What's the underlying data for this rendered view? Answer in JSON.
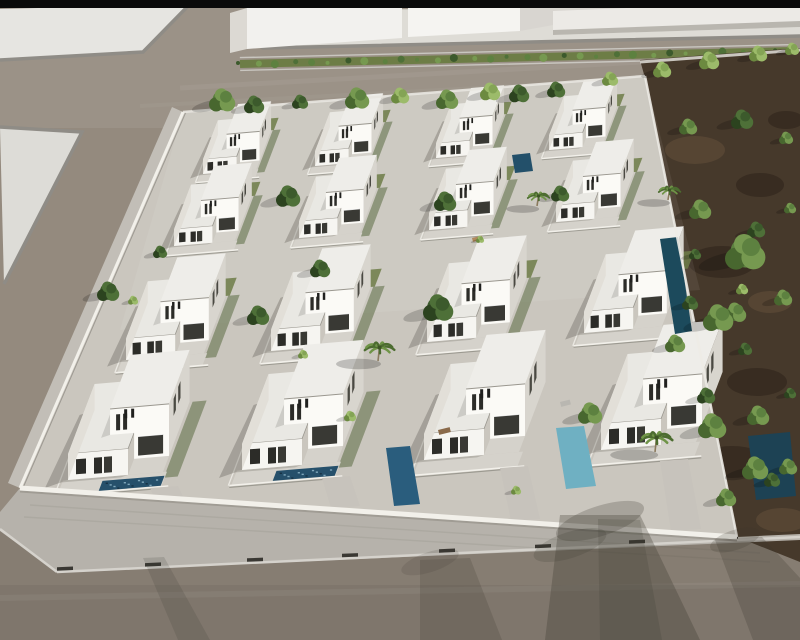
{
  "canvas": {
    "w": 800,
    "h": 640
  },
  "palette": {
    "black": "#0a0a0a",
    "road": "#948a7e",
    "plaza1": "#e6e5e1",
    "plaza2": "#dddcd7",
    "plaza3": "#dedcd6",
    "curb": "#8f8c86",
    "curb_light": "#d5d2cc",
    "building_face": "#f2f1ee",
    "building_side": "#dcd9d3",
    "building_roof": "#d8d5d0",
    "wall_band": "#eceae6",
    "wall_band_shade": "#b9b6af",
    "hedge_fill": "#6d7d46",
    "hedge_curb": "#c9c6c0",
    "dirt": "#46392b",
    "dirt_edge": "#cac6bf",
    "plot_ground": "#cac6be",
    "plot_left_band": "#c2beb7",
    "sidewalk_tile": "#b6b2ab",
    "wall_cap": "#f2f0ea",
    "wall_under": "#8a867e",
    "gate": "#3a3833",
    "roof_low": "#e9e8e3",
    "roof_high": "#eeede9",
    "roof_edge": "#9a978f",
    "wall_bright": "#f6f5f1",
    "wall_front": "#fbfaf6",
    "wall_mid": "#f1efe9",
    "wall_shade": "#e2dfd8",
    "wall_shade2": "#d8d5ce",
    "window": "#2c2c28",
    "window2": "#393934",
    "window_side": "#4a4942",
    "terrace": "#d5d2cb",
    "driveway": "#c7c3bc",
    "lawn": "#6d7c48",
    "lawn_dark": "#4f6136",
    "shadow": "#3a382f",
    "pool_mosaic": "#26506b",
    "pool_sp_l": "#8fb6c9",
    "pool_sp_d": "#142c3d",
    "palm_frond": "#6f9447",
    "palm_frond2": "#4c6c30",
    "palm_trunk": "#8a7a5e",
    "vent": "#20201e",
    "tree": {
      "d": [
        "#2c431f",
        "#3c5a2c",
        "#4e7038"
      ],
      "m": [
        "#48672f",
        "#5d8140",
        "#769950"
      ],
      "l": [
        "#6c8a40",
        "#84a455",
        "#9cbb6a"
      ]
    }
  },
  "black_strip": {
    "h": 8
  },
  "road_tints": [
    {
      "x": 0,
      "y": 8,
      "w": 800,
      "h": 120,
      "fill": "#ffffff",
      "op": 0.07
    },
    {
      "x": 0,
      "y": 520,
      "w": 800,
      "h": 120,
      "fill": "#000000",
      "op": 0.09
    },
    {
      "x": 0,
      "y": 585,
      "w": 800,
      "h": 55,
      "fill": "#000000",
      "op": 0.05
    }
  ],
  "road_lines": [
    [
      180,
      88,
      800,
      53,
      5,
      0.05,
      "#ffffff"
    ],
    [
      140,
      106,
      760,
      73,
      4,
      0.04,
      "#ffffff"
    ],
    [
      0,
      598,
      800,
      584,
      6,
      0.05,
      "#ffffff"
    ]
  ],
  "plazas": [
    {
      "name": "plaza-top-left",
      "pts": [
        [
          0,
          9
        ],
        [
          190,
          4
        ],
        [
          143,
          52
        ],
        [
          0,
          60
        ]
      ],
      "fill": "#e6e5e1",
      "curb_path": [
        [
          190,
          4
        ],
        [
          143,
          52
        ],
        [
          0,
          60
        ]
      ]
    },
    {
      "name": "plaza-left",
      "pts": [
        [
          0,
          127
        ],
        [
          82,
          132
        ],
        [
          4,
          284
        ]
      ],
      "fill": "#dddcd7",
      "curb_path": [
        [
          0,
          127
        ],
        [
          82,
          132
        ],
        [
          4,
          284
        ]
      ]
    },
    {
      "name": "plaza-top-forecourt",
      "pts": [
        [
          263,
          48
        ],
        [
          237,
          33
        ],
        [
          243,
          11
        ],
        [
          800,
          5
        ],
        [
          800,
          36
        ]
      ],
      "fill": "#dedcd6",
      "curb_path": [
        [
          237,
          33
        ],
        [
          263,
          48
        ],
        [
          800,
          36
        ]
      ]
    }
  ],
  "buildings": [
    {
      "name": "building-a-side",
      "pts": [
        [
          230,
          13
        ],
        [
          247,
          8
        ],
        [
          247,
          49
        ],
        [
          230,
          53
        ]
      ],
      "fill": "#dcd9d3"
    },
    {
      "name": "building-a-front",
      "pts": [
        [
          247,
          8
        ],
        [
          402,
          3
        ],
        [
          402,
          38
        ],
        [
          247,
          49
        ]
      ],
      "fill": "#f2f1ee"
    },
    {
      "name": "building-b-front",
      "pts": [
        [
          408,
          6
        ],
        [
          520,
          2
        ],
        [
          520,
          31
        ],
        [
          408,
          37
        ]
      ],
      "fill": "#f5f4f1"
    },
    {
      "name": "building-b-roof",
      "pts": [
        [
          520,
          2
        ],
        [
          622,
          0
        ],
        [
          637,
          10
        ],
        [
          520,
          31
        ]
      ],
      "fill": "#d8d5d0"
    },
    {
      "name": "building-c-wall",
      "pts": [
        [
          553,
          11
        ],
        [
          800,
          1
        ],
        [
          800,
          27
        ],
        [
          553,
          35
        ]
      ],
      "fill": "#eceae6"
    },
    {
      "name": "building-c-wall-shade",
      "pts": [
        [
          553,
          30
        ],
        [
          800,
          21
        ],
        [
          800,
          27
        ],
        [
          553,
          35
        ]
      ],
      "fill": "#b9b6af"
    }
  ],
  "hedge": {
    "x1": 240,
    "y1": 64,
    "x2": 795,
    "y2": 51,
    "half_w": 4,
    "bushes": 32
  },
  "dirt": {
    "pts": [
      [
        640,
        60
      ],
      [
        800,
        48
      ],
      [
        800,
        562
      ],
      [
        737,
        537
      ],
      [
        645,
        78
      ]
    ],
    "patches": [
      [
        695,
        150,
        30,
        14,
        "#5a4836"
      ],
      [
        760,
        185,
        24,
        12,
        "#35291f"
      ],
      [
        722,
        262,
        34,
        16,
        "#35291f"
      ],
      [
        690,
        360,
        26,
        13,
        "#5a4836"
      ],
      [
        757,
        382,
        30,
        14,
        "#35291f"
      ],
      [
        732,
        462,
        36,
        16,
        "#35291f"
      ],
      [
        782,
        520,
        26,
        12,
        "#5a4836"
      ],
      [
        700,
        520,
        20,
        10,
        "#5a4836"
      ],
      [
        786,
        120,
        18,
        9,
        "#35291f"
      ],
      [
        770,
        302,
        22,
        11,
        "#5a4836"
      ]
    ],
    "edge_line": [
      640,
      62,
      800,
      50
    ]
  },
  "plot": {
    "pts": [
      [
        183,
        112
      ],
      [
        645,
        76
      ],
      [
        737,
        537
      ],
      [
        20,
        488
      ]
    ],
    "left_band": [
      [
        183,
        112
      ],
      [
        20,
        488
      ],
      [
        8,
        483
      ],
      [
        172,
        107
      ]
    ],
    "light_top": [
      [
        183,
        112
      ],
      [
        645,
        76
      ],
      [
        700,
        290
      ],
      [
        120,
        330
      ]
    ],
    "walls": {
      "top": [
        183,
        112,
        645,
        76
      ],
      "left": [
        183,
        112,
        20,
        488
      ],
      "bottom": [
        20,
        488,
        737,
        537
      ],
      "right": [
        645,
        76,
        737,
        537
      ]
    }
  },
  "bottom_sidewalk": {
    "pts": [
      [
        20,
        488
      ],
      [
        737,
        537
      ],
      [
        800,
        534
      ],
      [
        800,
        540
      ],
      [
        57,
        572
      ],
      [
        0,
        531
      ],
      [
        0,
        512
      ]
    ],
    "curb": [
      57,
      572,
      800,
      537
    ],
    "bevel": [
      0,
      529,
      57,
      572
    ],
    "tile_lines": [
      [
        30,
        505,
        760,
        553
      ],
      [
        24,
        517,
        770,
        562
      ]
    ],
    "gates_x": [
      65,
      153,
      255,
      350,
      447,
      543,
      637,
      730
    ]
  },
  "villas": [
    {
      "x": 203,
      "y": 174,
      "s": 0.56,
      "row": 1,
      "col": 1,
      "pool": false,
      "lawn": true,
      "hedge": true
    },
    {
      "x": 315,
      "y": 166,
      "s": 0.56,
      "row": 1,
      "col": 2,
      "pool": false,
      "lawn": true,
      "hedge": true
    },
    {
      "x": 436,
      "y": 158,
      "s": 0.56,
      "row": 1,
      "col": 3,
      "pool": false,
      "lawn": true,
      "hedge": true
    },
    {
      "x": 549,
      "y": 150,
      "s": 0.56,
      "row": 1,
      "col": 4,
      "pool": false,
      "lawn": true,
      "hedge": true
    },
    {
      "x": 174,
      "y": 246,
      "s": 0.64,
      "row": 2,
      "col": 1,
      "pool": false,
      "lawn": true,
      "hedge": true
    },
    {
      "x": 299,
      "y": 238,
      "s": 0.64,
      "row": 2,
      "col": 2,
      "pool": false,
      "lawn": true,
      "hedge": true
    },
    {
      "x": 429,
      "y": 230,
      "s": 0.64,
      "row": 2,
      "col": 3,
      "pool": false,
      "lawn": true,
      "hedge": true
    },
    {
      "x": 556,
      "y": 222,
      "s": 0.64,
      "row": 2,
      "col": 4,
      "pool": false,
      "lawn": true,
      "hedge": true
    },
    {
      "x": 126,
      "y": 360,
      "s": 0.82,
      "row": 3,
      "col": 1,
      "pool": false,
      "lawn": true,
      "hedge": true
    },
    {
      "x": 271,
      "y": 351,
      "s": 0.82,
      "row": 3,
      "col": 2,
      "pool": false,
      "lawn": true,
      "hedge": true
    },
    {
      "x": 427,
      "y": 342,
      "s": 0.82,
      "row": 3,
      "col": 3,
      "pool": false,
      "lawn": true,
      "hedge": true
    },
    {
      "x": 584,
      "y": 333,
      "s": 0.82,
      "row": 3,
      "col": 4,
      "pool": false,
      "lawn": true,
      "hedge": false
    },
    {
      "x": 68,
      "y": 480,
      "s": 1.0,
      "row": 4,
      "col": 1,
      "pool": true,
      "lawn": false,
      "hedge": true
    },
    {
      "x": 242,
      "y": 470,
      "s": 1.0,
      "row": 4,
      "col": 2,
      "pool": true,
      "lawn": false,
      "hedge": true
    },
    {
      "x": 424,
      "y": 460,
      "s": 1.0,
      "row": 4,
      "col": 3,
      "pool": false,
      "lawn": false,
      "hedge": false
    },
    {
      "x": 601,
      "y": 450,
      "s": 1.0,
      "row": 4,
      "col": 4,
      "pool": false,
      "lawn": false,
      "hedge": false
    }
  ],
  "extra_pools": [
    {
      "name": "lap-pool-right-column",
      "pts": [
        [
          660,
          239
        ],
        [
          678,
          237
        ],
        [
          692,
          331
        ],
        [
          675,
          334
        ]
      ],
      "fill": "#1c4a5c"
    },
    {
      "name": "pool-villa-r4c2",
      "pts": [
        [
          386,
          448
        ],
        [
          410,
          446
        ],
        [
          420,
          504
        ],
        [
          394,
          506
        ]
      ],
      "fill": "#2a5d7d"
    },
    {
      "name": "pool-villa-r4c3",
      "pts": [
        [
          556,
          428
        ],
        [
          584,
          426
        ],
        [
          596,
          486
        ],
        [
          566,
          489
        ]
      ],
      "fill": "#6fb0c2"
    },
    {
      "name": "pool-corner-dark",
      "pts": [
        [
          748,
          436
        ],
        [
          790,
          432
        ],
        [
          796,
          496
        ],
        [
          756,
          500
        ]
      ],
      "fill": "#1d4254"
    },
    {
      "name": "pool-strip-top",
      "pts": [
        [
          512,
          155
        ],
        [
          530,
          153
        ],
        [
          533,
          171
        ],
        [
          515,
          173
        ]
      ],
      "fill": "#23506a"
    }
  ],
  "driveways": [
    [
      [
        150,
        488
      ],
      [
        178,
        486
      ],
      [
        184,
        499
      ],
      [
        156,
        501
      ]
    ],
    [
      [
        322,
        478
      ],
      [
        350,
        476
      ],
      [
        360,
        506
      ],
      [
        331,
        508
      ]
    ],
    [
      [
        500,
        468
      ],
      [
        528,
        466
      ],
      [
        540,
        519
      ],
      [
        511,
        521
      ]
    ],
    [
      [
        660,
        461
      ],
      [
        688,
        459
      ],
      [
        701,
        529
      ],
      [
        671,
        531
      ]
    ]
  ],
  "furniture": [
    {
      "x": 45,
      "y": 500,
      "w": 16,
      "h": 8,
      "fill": "#4f4e49"
    },
    {
      "x": 77,
      "y": 503,
      "w": 17,
      "h": 6,
      "fill": "#7a5a3e"
    },
    {
      "x": 158,
      "y": 504,
      "w": 14,
      "h": 5,
      "fill": "#d9d7d1"
    },
    {
      "x": 438,
      "y": 430,
      "w": 12,
      "h": 5,
      "fill": "#8a6a4a"
    },
    {
      "x": 560,
      "y": 402,
      "w": 10,
      "h": 5,
      "fill": "#b9b7b1"
    },
    {
      "x": 472,
      "y": 238,
      "w": 10,
      "h": 4,
      "fill": "#b0885c"
    }
  ],
  "trees": [
    [
      222,
      102,
      13,
      "m"
    ],
    [
      254,
      106,
      10,
      "d"
    ],
    [
      300,
      103,
      8,
      "d"
    ],
    [
      357,
      100,
      12,
      "m"
    ],
    [
      400,
      97,
      9,
      "l"
    ],
    [
      447,
      101,
      11,
      "m"
    ],
    [
      490,
      93,
      10,
      "l"
    ],
    [
      519,
      95,
      10,
      "d"
    ],
    [
      556,
      91,
      9,
      "d"
    ],
    [
      610,
      80,
      8,
      "l"
    ],
    [
      662,
      71,
      9,
      "l"
    ],
    [
      709,
      62,
      10,
      "l"
    ],
    [
      758,
      55,
      9,
      "l"
    ],
    [
      792,
      50,
      7,
      "l"
    ],
    [
      288,
      198,
      12,
      "d"
    ],
    [
      445,
      203,
      11,
      "d"
    ],
    [
      560,
      195,
      9,
      "d"
    ],
    [
      320,
      270,
      10,
      "d"
    ],
    [
      438,
      310,
      15,
      "d"
    ],
    [
      258,
      317,
      11,
      "d"
    ],
    [
      108,
      293,
      11,
      "d"
    ],
    [
      160,
      253,
      7,
      "d"
    ],
    [
      590,
      415,
      12,
      "m"
    ],
    [
      675,
      345,
      10,
      "m"
    ],
    [
      745,
      255,
      20,
      "m"
    ],
    [
      718,
      320,
      15,
      "m"
    ],
    [
      712,
      428,
      14,
      "m"
    ],
    [
      755,
      470,
      13,
      "m"
    ],
    [
      788,
      468,
      9,
      "m"
    ],
    [
      350,
      417,
      6,
      "l"
    ],
    [
      516,
      491,
      5,
      "l"
    ],
    [
      133,
      301,
      5,
      "l"
    ],
    [
      480,
      240,
      4,
      "l"
    ],
    [
      742,
      290,
      6,
      "l"
    ],
    [
      303,
      355,
      5,
      "l"
    ],
    [
      688,
      128,
      9,
      "m"
    ],
    [
      742,
      121,
      11,
      "d"
    ],
    [
      786,
      139,
      7,
      "m"
    ],
    [
      700,
      211,
      11,
      "m"
    ],
    [
      756,
      231,
      9,
      "d"
    ],
    [
      790,
      209,
      6,
      "m"
    ],
    [
      690,
      304,
      8,
      "d"
    ],
    [
      735,
      314,
      11,
      "m"
    ],
    [
      783,
      299,
      9,
      "m"
    ],
    [
      706,
      397,
      9,
      "d"
    ],
    [
      758,
      417,
      11,
      "m"
    ],
    [
      790,
      394,
      6,
      "d"
    ],
    [
      726,
      499,
      10,
      "m"
    ],
    [
      772,
      481,
      8,
      "d"
    ],
    [
      745,
      350,
      7,
      "d"
    ],
    [
      695,
      255,
      6,
      "d"
    ]
  ],
  "palms": [
    [
      537,
      206,
      11
    ],
    [
      378,
      361,
      15
    ],
    [
      668,
      200,
      11
    ],
    [
      655,
      452,
      16
    ]
  ],
  "road_shadows": [
    {
      "pts": [
        [
          560,
          515
        ],
        [
          640,
          515
        ],
        [
          700,
          640
        ],
        [
          545,
          640
        ]
      ],
      "op": 0.3
    },
    {
      "pts": [
        [
          598,
          519
        ],
        [
          640,
          520
        ],
        [
          662,
          640
        ],
        [
          600,
          640
        ]
      ],
      "op": 0.18
    },
    {
      "pts": [
        [
          420,
          560
        ],
        [
          470,
          558
        ],
        [
          502,
          640
        ],
        [
          420,
          640
        ]
      ],
      "op": 0.2
    },
    {
      "pts": [
        [
          715,
          540
        ],
        [
          762,
          537
        ],
        [
          800,
          578
        ],
        [
          800,
          640
        ],
        [
          753,
          640
        ]
      ],
      "op": 0.24
    },
    {
      "pts": [
        [
          143,
          558
        ],
        [
          164,
          557
        ],
        [
          210,
          640
        ],
        [
          178,
          640
        ]
      ],
      "op": 0.16
    }
  ],
  "shadow_blobs": [
    [
      600,
      521,
      46,
      15,
      0.24
    ],
    [
      735,
      540,
      26,
      10,
      0.2
    ],
    [
      430,
      562,
      30,
      10,
      0.15
    ],
    [
      570,
      545,
      38,
      13,
      0.18
    ]
  ]
}
